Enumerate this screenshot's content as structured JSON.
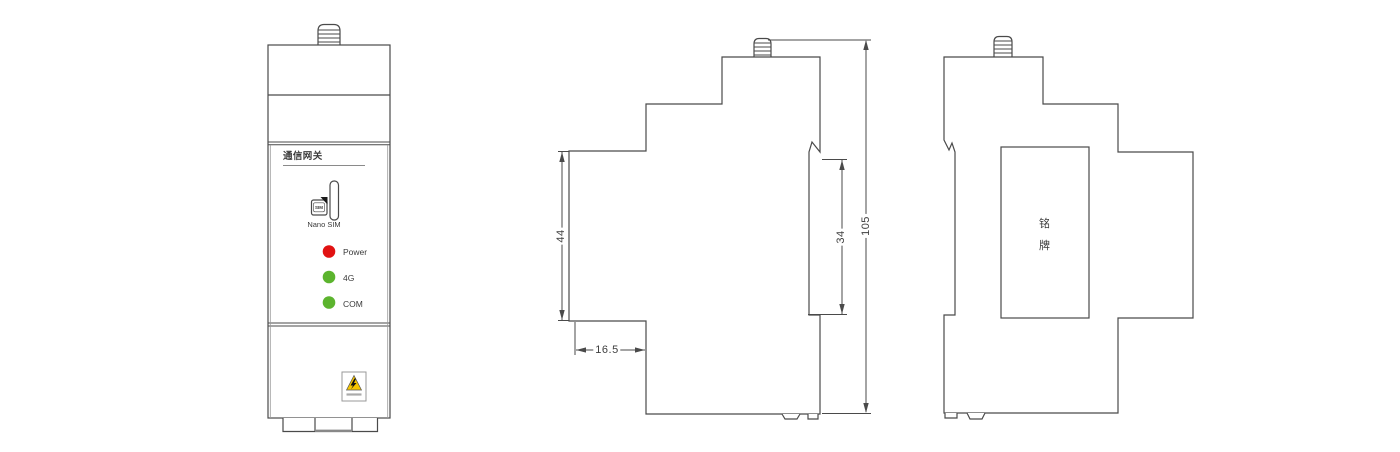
{
  "views": {
    "front": {
      "product_label": "通信网关",
      "sim": {
        "icon_text": "SIM",
        "label": "Nano SIM"
      },
      "leds": [
        {
          "label": "Power",
          "color": "#e11212"
        },
        {
          "label": "4G",
          "color": "#5cb42e"
        },
        {
          "label": "COM",
          "color": "#5cb42e"
        }
      ],
      "warning": {
        "icon": "high-voltage-warning-icon",
        "triangle_color": "#f6c500"
      }
    },
    "side": {
      "dimensions": {
        "overall_height": "105",
        "left_section_height": "44",
        "rail_mount_height": "34",
        "bottom_step_width": "16.5"
      }
    },
    "back": {
      "nameplate": "铭牌"
    }
  },
  "icons": {
    "antenna": "antenna-connector-icon",
    "sim_card": "sim-card-icon",
    "sim_slot": "sim-slot-icon",
    "warning": "high-voltage-warning-icon"
  },
  "style": {
    "line_color": "#4a4a4a",
    "text_color": "#3a3a3a",
    "background": "#ffffff"
  }
}
